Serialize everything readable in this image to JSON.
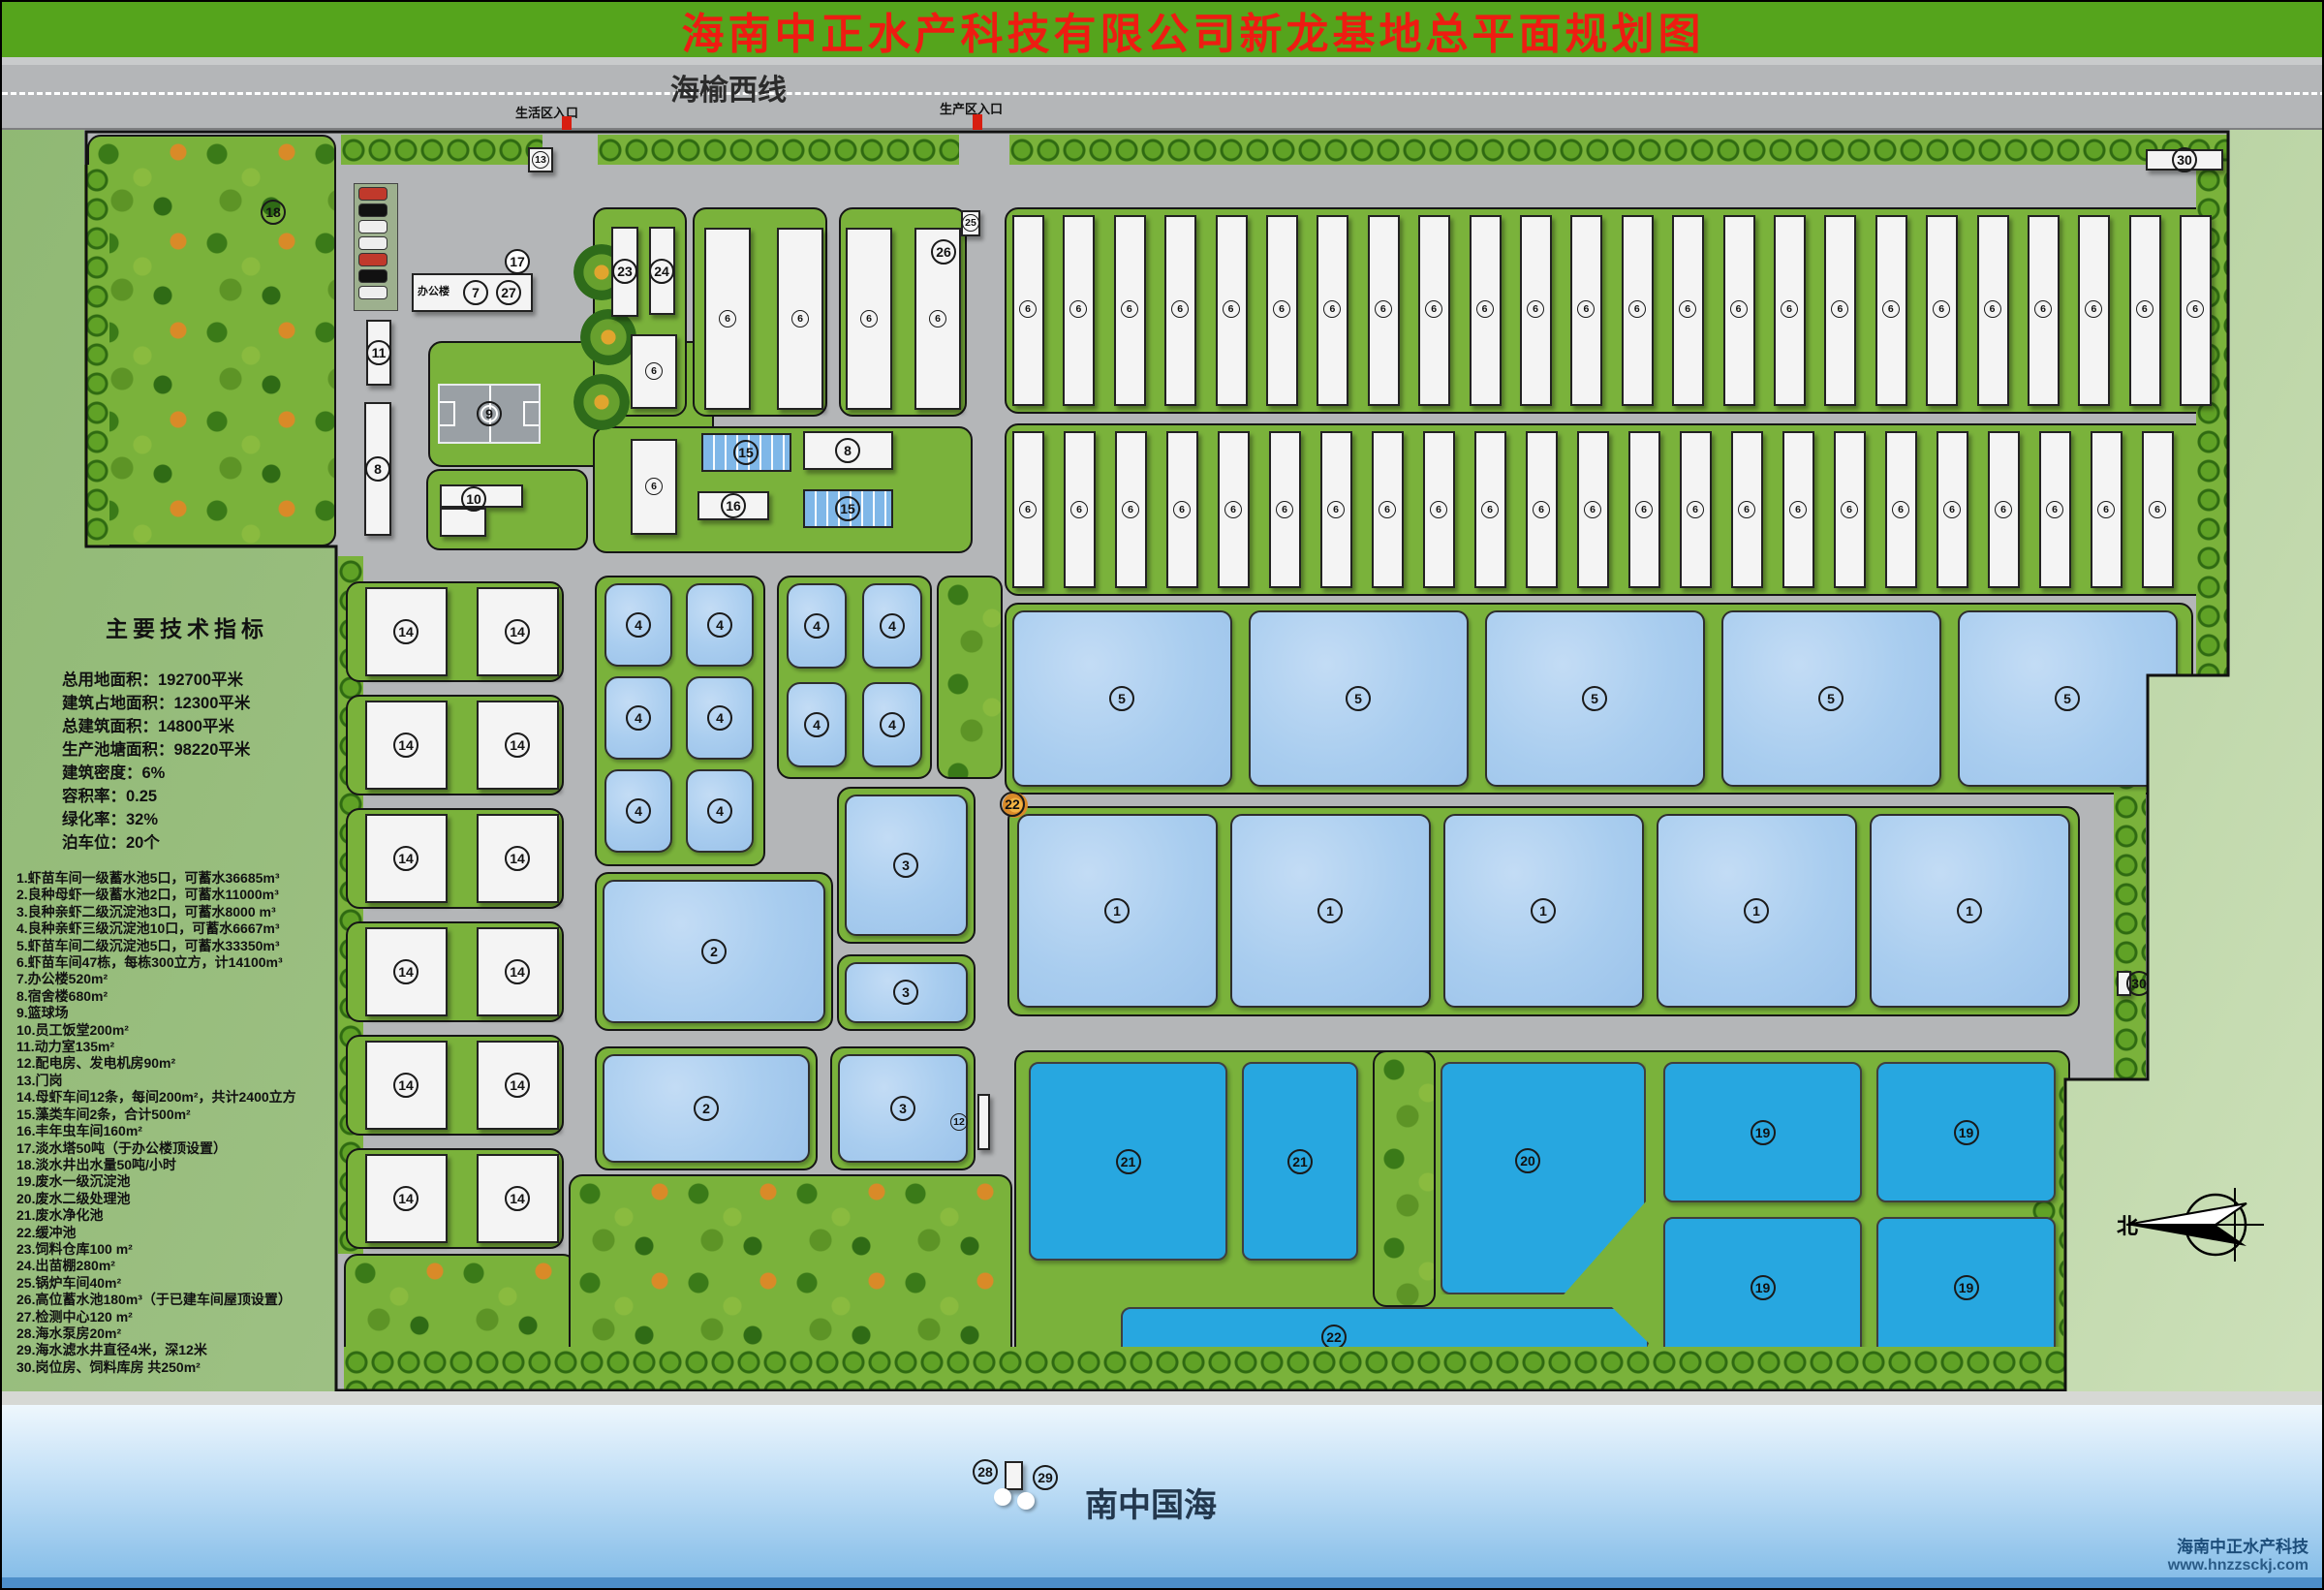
{
  "title": "海南中正水产科技有限公司新龙基地总平面规划图",
  "road": {
    "name": "海榆西线",
    "entrance_left": "生活区入口",
    "entrance_right": "生产区入口"
  },
  "legend": {
    "title": "主要技术指标",
    "stats": [
      "总用地面积：192700平米",
      "建筑占地面积：12300平米",
      "总建筑面积：14800平米",
      "生产池塘面积：98220平米",
      "建筑密度：6%",
      "容积率：0.25",
      "绿化率：32%",
      "泊车位：20个"
    ],
    "items": [
      "1.虾苗车间一级蓄水池5口，可蓄水36685m³",
      "2.良种母虾一级蓄水池2口，可蓄水11000m³",
      "3.良种亲虾二级沉淀池3口，可蓄水8000 m³",
      "4.良种亲虾三级沉淀池10口，可蓄水6667m³",
      "5.虾苗车间二级沉淀池5口，可蓄水33350m³",
      "6.虾苗车间47栋，每栋300立方，计14100m³",
      "7.办公楼520m²",
      "8.宿舍楼680m²",
      "9.篮球场",
      "10.员工饭堂200m²",
      "11.动力室135m²",
      "12.配电房、发电机房90m²",
      "13.门岗",
      "14.母虾车间12条，每间200m²，共计2400立方",
      "15.藻类车间2条，合计500m²",
      "16.丰年虫车间160m²",
      "17.淡水塔50吨（于办公楼顶设置）",
      "18.淡水井出水量50吨/小时",
      "19.废水一级沉淀池",
      "20.废水二级处理池",
      "21.废水净化池",
      "22.缓冲池",
      "23.饲料仓库100 m²",
      "24.出苗棚280m²",
      "25.锅炉车间40m²",
      "26.高位蓄水池180m³（于已建车间屋顶设置）",
      "27.检测中心120 m²",
      "28.海水泵房20m²",
      "29.海水滤水井直径4米，深12米",
      "30.岗位房、饲料库房 共250m²"
    ]
  },
  "map": {
    "workshop": {
      "label": "6",
      "count_row1": 24,
      "count_row2": 23
    },
    "broodstock": {
      "label": "14",
      "count": 12
    },
    "sediment2_ponds": {
      "label": "5",
      "count": 5
    },
    "intake_ponds": {
      "label": "1",
      "count": 5
    },
    "pond4": {
      "label": "4",
      "count": 10
    },
    "pond3": {
      "label": "3",
      "count": 3
    },
    "pond2": {
      "label": "2",
      "count": 2
    },
    "bottom_pond_labels": [
      "21",
      "21",
      "20",
      "19",
      "19",
      "19",
      "19",
      "22"
    ],
    "buildings": {
      "office_text": "办公楼",
      "office": "7",
      "inspection": "27",
      "tower": "17",
      "dorm": "8",
      "court": "9",
      "canteen": "10",
      "power": "11",
      "electric": "12",
      "gate": "13",
      "well": "18",
      "algae": "15",
      "artemia": "16",
      "dorm2": "8",
      "feed_store": "23",
      "nursery": "24",
      "boiler": "25",
      "elevated_tank": "26",
      "buffer_mark": "22",
      "pump": "28",
      "filter_well": "29",
      "guard_top": "30",
      "guard_right": "30"
    }
  },
  "sea": {
    "name": "南中国海"
  },
  "compass": {
    "north": "北"
  },
  "watermark": {
    "company": "海南中正水产科技",
    "url": "www.hnzzsckj.com"
  }
}
